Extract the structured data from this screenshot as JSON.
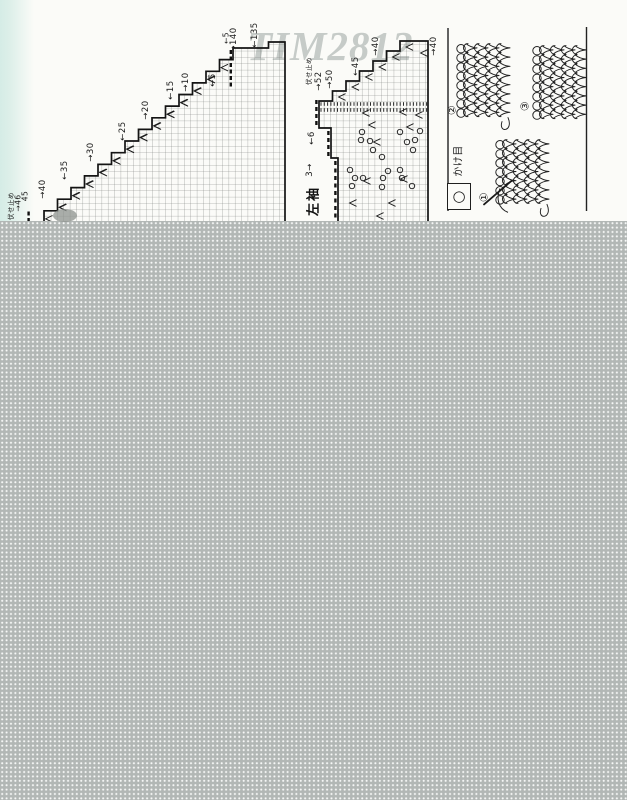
{
  "watermark": "TIM2812",
  "charts": {
    "left_chart": {
      "bottom_labels": [
        {
          "text": "伏せ止め",
          "x": 10,
          "y": 206,
          "fs": 6.5
        },
        {
          "text": "→46",
          "x": 18,
          "y": 203,
          "fs": 7.5
        },
        {
          "text": "45",
          "x": 25,
          "y": 196,
          "fs": 7.5
        }
      ],
      "diagonal_labels": [
        {
          "text": "→40",
          "x": 43,
          "y": 189
        },
        {
          "text": "←35",
          "x": 65,
          "y": 170
        },
        {
          "text": "→30",
          "x": 91,
          "y": 152
        },
        {
          "text": "←25",
          "x": 123,
          "y": 131
        },
        {
          "text": "→20",
          "x": 146,
          "y": 110
        },
        {
          "text": "←15",
          "x": 171,
          "y": 90
        },
        {
          "text": "→10",
          "x": 186,
          "y": 82
        },
        {
          "text": "←5",
          "x": 213,
          "y": 80
        }
      ],
      "top_labels": [
        {
          "text": "←5",
          "x": 226,
          "y": 38,
          "fs": 7.5
        },
        {
          "text": "→140",
          "x": 234,
          "y": 40
        },
        {
          "text": "←135",
          "x": 255,
          "y": 35
        }
      ]
    },
    "middle_chart": {
      "top_labels": [
        {
          "text": "伏せ止め",
          "x": 308,
          "y": 71,
          "fs": 6.5
        },
        {
          "text": "→52",
          "x": 319,
          "y": 81
        },
        {
          "text": "→50",
          "x": 330,
          "y": 79
        },
        {
          "text": "←45",
          "x": 356,
          "y": 66
        },
        {
          "text": "→40",
          "x": 376,
          "y": 46
        },
        {
          "text": "→40",
          "x": 434,
          "y": 46
        }
      ],
      "side_labels": [
        {
          "text": "←6",
          "x": 312,
          "y": 138
        },
        {
          "text": "3→",
          "x": 310,
          "y": 170
        }
      ],
      "sleeve_label": {
        "text": "左袖",
        "x": 312,
        "y": 201,
        "fs": 13
      },
      "yarn_overs": [
        [
          362,
          132
        ],
        [
          400,
          132
        ],
        [
          361,
          140
        ],
        [
          370,
          141
        ],
        [
          407,
          142
        ],
        [
          415,
          140
        ],
        [
          373,
          150
        ],
        [
          413,
          150
        ],
        [
          382,
          157
        ],
        [
          350,
          170
        ],
        [
          388,
          171
        ],
        [
          400,
          170
        ],
        [
          355,
          178
        ],
        [
          363,
          178
        ],
        [
          383,
          178
        ],
        [
          402,
          178
        ],
        [
          420,
          131
        ],
        [
          382,
          187
        ],
        [
          352,
          186
        ],
        [
          412,
          186
        ]
      ],
      "decreases": [
        [
          366,
          113
        ],
        [
          403,
          112
        ],
        [
          372,
          125
        ],
        [
          410,
          127
        ],
        [
          377,
          142
        ],
        [
          404,
          179
        ],
        [
          367,
          181
        ],
        [
          353,
          203
        ],
        [
          392,
          203
        ],
        [
          380,
          216
        ],
        [
          419,
          115
        ],
        [
          424,
          53
        ]
      ]
    }
  },
  "legend": {
    "symbol": "○",
    "label": "かけ目"
  },
  "figures": [
    {
      "number": "②",
      "x": 452,
      "y": 110
    },
    {
      "number": "③",
      "x": 525,
      "y": 106
    },
    {
      "number": "①",
      "x": 484,
      "y": 197
    }
  ],
  "colors": {
    "paper": "#fbfbf8",
    "edge_tint": "#d9ede8",
    "gray_block": "#b2b7b5",
    "watermark": "#c6cbc8",
    "ink": "#1a1a1a",
    "grid_line": "#7b807b"
  }
}
